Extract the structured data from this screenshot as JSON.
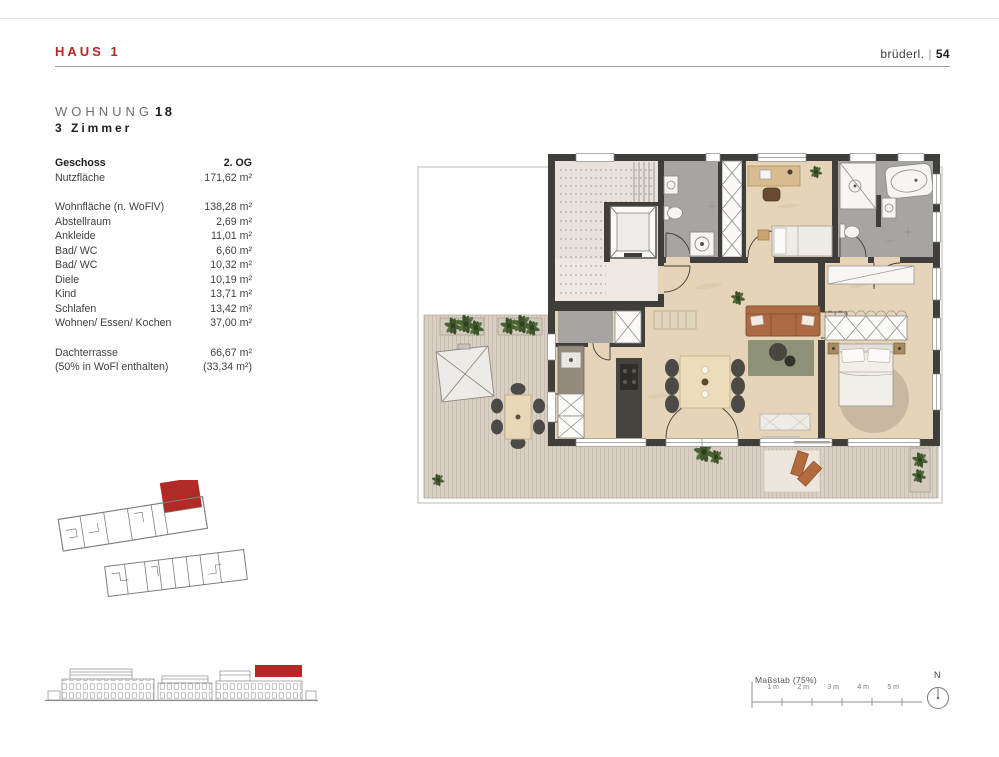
{
  "header": {
    "haus": "HAUS 1",
    "brand": "brüderl.",
    "brand_sep": "|",
    "page_number": "54"
  },
  "title": {
    "label": "WOHNUNG",
    "number": "18",
    "subtitle": "3 Zimmer"
  },
  "area_table": {
    "rows": [
      {
        "label": "Geschoss",
        "value": "2. OG"
      },
      {
        "label": "Nutzfläche",
        "value": "171,62 m²"
      },
      {
        "label": "Wohnfläche (n. WoFlV)",
        "value": "138,28 m²"
      },
      {
        "label": "Abstellraum",
        "value": "2,69 m²"
      },
      {
        "label": "Ankleide",
        "value": "11,01 m²"
      },
      {
        "label": "Bad/ WC",
        "value": "6,60 m²"
      },
      {
        "label": "Bad/ WC",
        "value": "10,32 m²"
      },
      {
        "label": "Diele",
        "value": "10,19 m²"
      },
      {
        "label": "Kind",
        "value": "13,71 m²"
      },
      {
        "label": "Schlafen",
        "value": "13,42 m²"
      },
      {
        "label": "Wohnen/ Essen/ Kochen",
        "value": "37,00 m²"
      },
      {
        "label": "Dachterrasse",
        "value": "66,67 m²"
      },
      {
        "label": "(50% in WoFl enthalten)",
        "value": "(33,34 m²)"
      }
    ]
  },
  "footer": {
    "scale_label": "Maßstab (75%)",
    "ticks": [
      "1 m",
      "2 m",
      "3 m",
      "4 m",
      "5 m"
    ],
    "compass": "N"
  },
  "colors": {
    "accent": "#b22a26",
    "wall": "#3f3e3b",
    "floor": "#e6d4b8",
    "deck": "#d9cfc3",
    "bath_gray": "#a6a5a1",
    "stair_pink": "#e9e1dc",
    "rug_green": "#8e9377",
    "sofa_brown": "#ab6a44"
  }
}
